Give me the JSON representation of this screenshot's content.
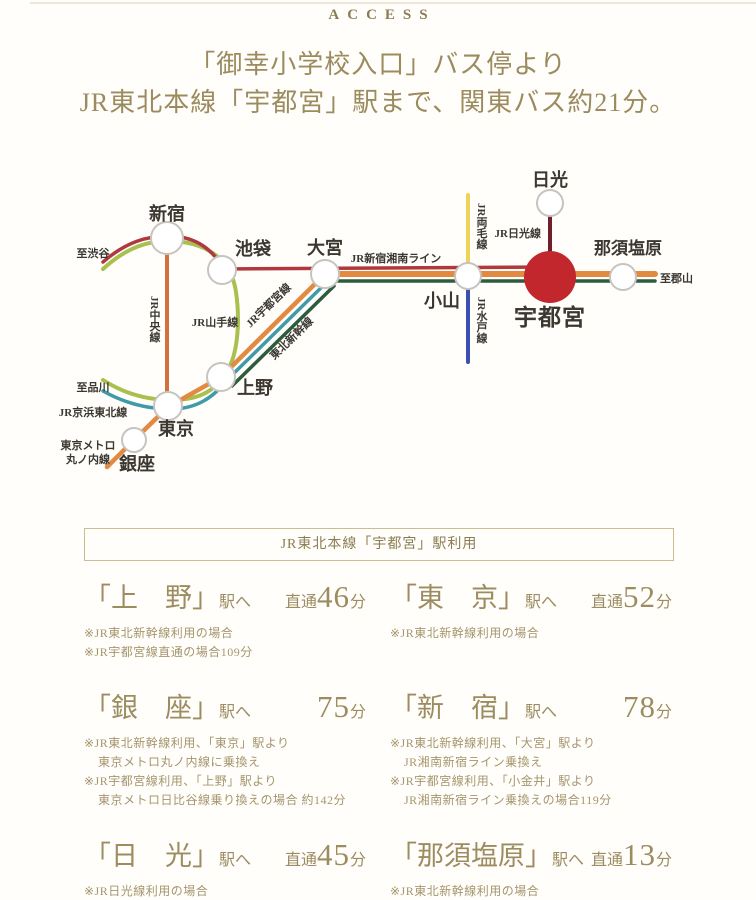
{
  "header": {
    "access_label": "ACCESS",
    "title_line1": "「御幸小学校入口」バス停より",
    "title_line2": "JR東北本線「宇都宮」駅まで、関東バス約21分。"
  },
  "diagram": {
    "stations": {
      "shinjuku": "新宿",
      "ikebukuro": "池袋",
      "omiya": "大宮",
      "oyama": "小山",
      "utsunomiya": "宇都宮",
      "nikko": "日光",
      "nasushiobara": "那須塩原",
      "ueno": "上野",
      "tokyo": "東京",
      "ginza": "銀座"
    },
    "line_labels": {
      "shonan_shinjuku": "JR新宿湘南ライン",
      "yamanote": "JR山手線",
      "chuo": "JR中央線",
      "utsunomiya_line": "JR宇都宮線",
      "tohoku_shinkansen": "東北新幹線",
      "keihin_tohoku": "JR京浜東北線",
      "ryomo": "JR両毛線",
      "mito": "JR水戸線",
      "nikko_line": "JR日光線",
      "marunouchi_1": "東京メトロ",
      "marunouchi_2": "丸ノ内線",
      "to_shibuya": "至渋谷",
      "to_shinagawa": "至品川",
      "to_koriyama": "至郡山"
    },
    "colors": {
      "line_shonan_shinjuku": "#b0393f",
      "line_yamanote": "#a9c04f",
      "line_chuo": "#d4703c",
      "line_utsunomiya": "#e28a41",
      "line_keihin_tohoku": "#3f9aa9",
      "line_shinkansen": "#2d5c3c",
      "line_ryomo": "#ecd35a",
      "line_mito": "#3c50b4",
      "line_nikko": "#701f2b",
      "station_highlight": "#c1272d",
      "accent_text": "#9c8b5e",
      "box_border": "#c9bd92"
    }
  },
  "usage": {
    "box_title": "JR東北本線「宇都宮」駅利用"
  },
  "routes": [
    {
      "name": "「上　野」",
      "dest_suffix": "駅へ",
      "time_prefix": "直通",
      "time_value": "46",
      "time_unit": "分",
      "notes": [
        "※JR東北新幹線利用の場合",
        "※JR宇都宮線直通の場合109分"
      ]
    },
    {
      "name": "「東　京」",
      "dest_suffix": "駅へ",
      "time_prefix": "直通",
      "time_value": "52",
      "time_unit": "分",
      "notes": [
        "※JR東北新幹線利用の場合"
      ]
    },
    {
      "name": "「銀　座」",
      "dest_suffix": "駅へ",
      "time_prefix": "",
      "time_value": "75",
      "time_unit": "分",
      "notes": [
        "※JR東北新幹線利用、「東京」駅より",
        "東京メトロ丸ノ内線に乗換え",
        "※JR宇都宮線利用、「上野」駅より",
        "東京メトロ日比谷線乗り換えの場合 約142分"
      ]
    },
    {
      "name": "「新　宿」",
      "dest_suffix": "駅へ",
      "time_prefix": "",
      "time_value": "78",
      "time_unit": "分",
      "notes": [
        "※JR東北新幹線利用、「大宮」駅より",
        "JR湘南新宿ライン乗換え",
        "※JR宇都宮線利用、「小金井」駅より",
        "JR湘南新宿ライン乗換えの場合119分"
      ]
    },
    {
      "name": "「日　光」",
      "dest_suffix": "駅へ",
      "time_prefix": "直通",
      "time_value": "45",
      "time_unit": "分",
      "notes": [
        "※JR日光線利用の場合"
      ]
    },
    {
      "name": "「那須塩原」",
      "dest_suffix": "駅へ",
      "time_prefix": "直通",
      "time_value": "13",
      "time_unit": "分",
      "notes": [
        "※JR東北新幹線利用の場合",
        "※JR宇都宮線直通の場合46分"
      ]
    }
  ]
}
